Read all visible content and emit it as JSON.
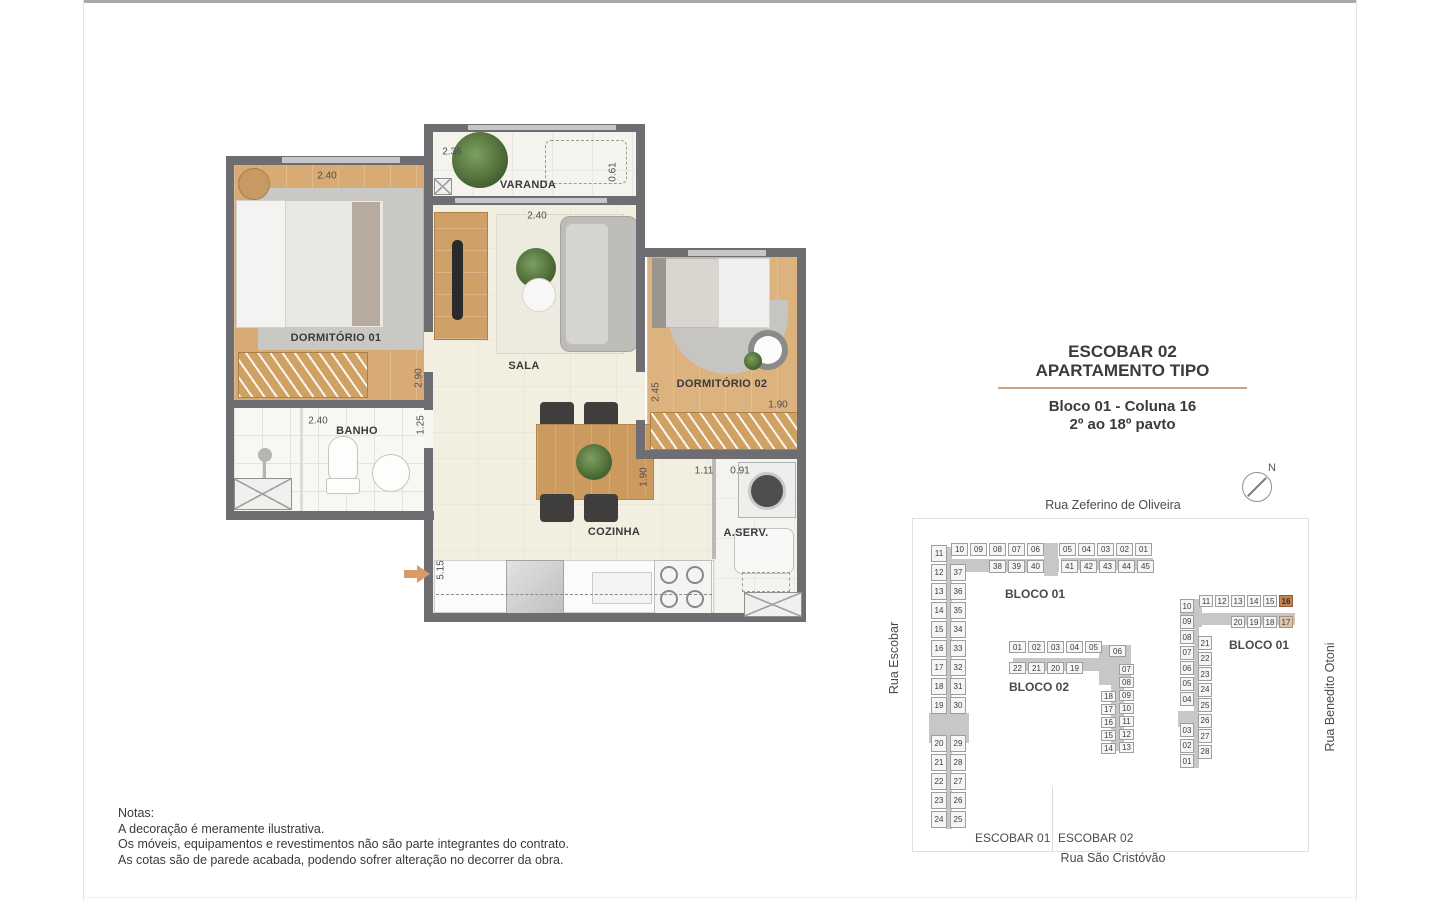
{
  "title_block": {
    "project": "ESCOBAR 02",
    "subtitle": "APARTAMENTO TIPO",
    "block_info": "Bloco 01 - Coluna 16",
    "floors": "2º ao 18º pavto"
  },
  "floor_plan": {
    "rooms": {
      "dorm1": "DORMITÓRIO 01",
      "banho": "BANHO",
      "varanda": "VARANDA",
      "sala": "SALA",
      "dorm2": "DORMITÓRIO 02",
      "cozinha": "COZINHA",
      "aserv": "A.SERV."
    },
    "dims": {
      "dorm1_w": "2.40",
      "dorm1_h": "2.90",
      "banho_w": "2.40",
      "banho_h": "1.25",
      "varanda_w": "2.36",
      "varanda_h": "0.61",
      "sala_w": "2.40",
      "dorm2_h": "2.45",
      "dorm2_w": "1.90",
      "coz_h": "1.90",
      "coz_w": "1.11",
      "aserv_w": "0.91",
      "coz_len": "5.15"
    }
  },
  "site_plan": {
    "streets": {
      "top": "Rua Zeferino de Oliveira",
      "left": "Rua Escobar",
      "right": "Rua Benedito Otoni",
      "bottom": "Rua São Cristóvão"
    },
    "compass_n": "N",
    "labels": {
      "blocoA": "BLOCO 01",
      "blocoB": "BLOCO 02",
      "blocoC": "BLOCO 01",
      "lot1": "ESCOBAR 01",
      "lot2": "ESCOBAR 02"
    },
    "highlight_colors": {
      "primary": "#c08457",
      "secondary": "#dcc4ad"
    },
    "blockA": {
      "row1a": [
        "10",
        "09",
        "08",
        "07",
        "06"
      ],
      "row1b": [
        "05",
        "04",
        "03",
        "02",
        "01"
      ],
      "row2a": [
        "38",
        "39",
        "40"
      ],
      "row2b": [
        "41",
        "42",
        "43",
        "44",
        "45"
      ],
      "colOuter": [
        "11",
        "12",
        "13",
        "14",
        "15",
        "16",
        "17",
        "18",
        "19",
        null,
        "20",
        "21",
        "22",
        "23",
        "24"
      ],
      "colInner": [
        "37",
        "36",
        "35",
        "34",
        "33",
        "32",
        "31",
        "30",
        null,
        "29",
        "28",
        "27",
        "26",
        "25"
      ]
    },
    "blockB": {
      "row1": [
        "01",
        "02",
        "03",
        "04",
        "05"
      ],
      "unit06": [
        "06"
      ],
      "row2": [
        "22",
        "21",
        "20",
        "19"
      ],
      "colLeft": [
        "18",
        "17",
        "16",
        "15",
        "14"
      ],
      "colRight": [
        "07",
        "08",
        "09",
        "10",
        "11",
        "12",
        "13"
      ]
    },
    "blockC": {
      "row1": [
        "11",
        "12",
        "13",
        "14",
        "15",
        {
          "n": "16",
          "h": 1
        }
      ],
      "row2": [
        "20",
        "19",
        "18",
        {
          "n": "17",
          "h": 2
        }
      ],
      "colOuter": [
        "10",
        "09",
        "08",
        "07",
        "06",
        "05",
        "04",
        null,
        "03",
        "02",
        "01"
      ],
      "colInner": [
        "21",
        "22",
        "23",
        "24",
        "25",
        "26",
        "27",
        "28"
      ]
    }
  },
  "notes": {
    "heading": "Notas:",
    "lines": [
      "A decoração é meramente ilustrativa.",
      "Os móveis, equipamentos e revestimentos não são parte integrantes do contrato.",
      "As cotas são de parede acabada, podendo sofrer alteração no decorrer da obra."
    ]
  }
}
